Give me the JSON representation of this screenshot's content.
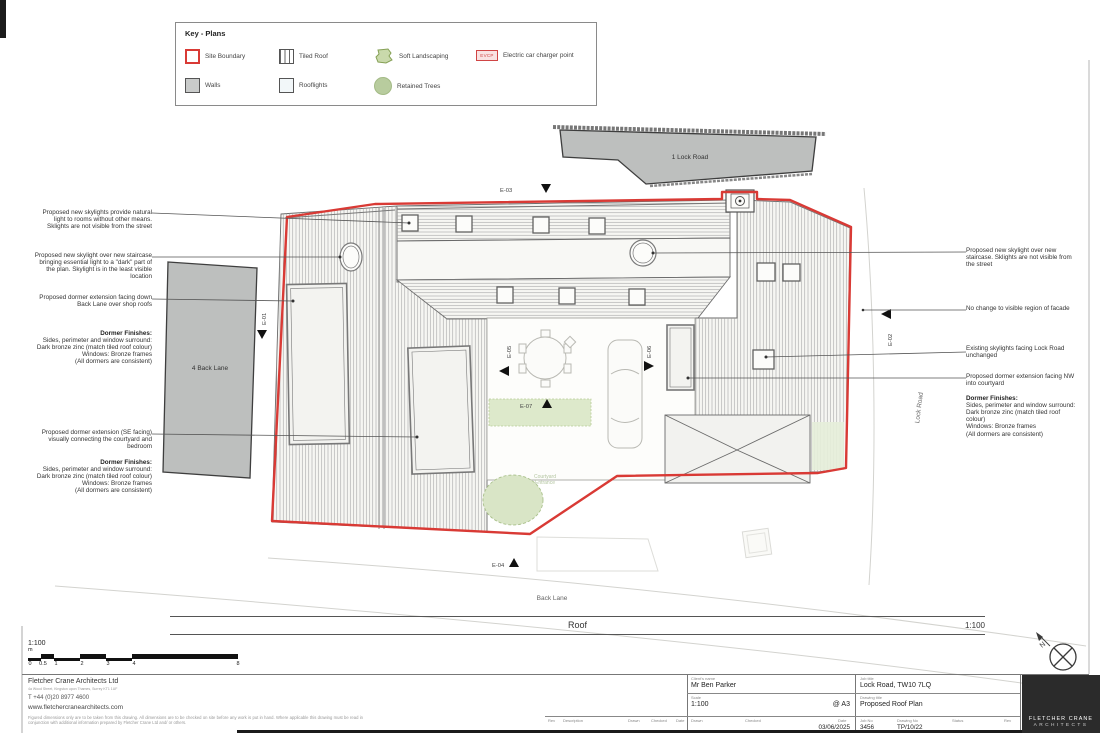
{
  "legend": {
    "title": "Key - Plans",
    "items": [
      {
        "label": "Site Boundary"
      },
      {
        "label": "Tiled Roof"
      },
      {
        "label": "Soft Landscaping"
      },
      {
        "label": "Electric car charger point",
        "badge": "EVCP"
      },
      {
        "label": "Walls"
      },
      {
        "label": "Rooflights"
      },
      {
        "label": "Retained Trees"
      }
    ]
  },
  "plan": {
    "buildings": {
      "lock_road": "1 Lock Road",
      "back_lane": "4 Back Lane"
    },
    "streets": {
      "back_lane": "Back Lane",
      "lock_road": "Lock Road"
    },
    "courtyard_line1": "Courtyard",
    "courtyard_line2": "Entrance",
    "markers": {
      "e01": "E-01",
      "e02": "E-02",
      "e03": "E-03",
      "e04": "E-04",
      "e05": "E-05",
      "e06": "E-06",
      "e07": "E-07"
    },
    "compass_label": "N"
  },
  "annotations": {
    "left": [
      {
        "text": "Proposed new skylights provide natural light to rooms without other means. Sklights are not visible from the street"
      },
      {
        "text": "Proposed new skylight over new staircase bringing essential light to a \"dark\" part of the plan. Skylight is in the least visible location"
      },
      {
        "text": "Proposed dormer extension facing down Back Lane over shop roofs"
      },
      {
        "title": "Dormer Finishes:",
        "text": "Sides, perimeter and window surround: Dark bronze zinc (match tiled roof colour)\nWindows: Bronze frames\n(All dormers are consistent)"
      },
      {
        "text": "Proposed dormer extension (SE facing) visually connecting the courtyard and bedroom"
      },
      {
        "title": "Dormer Finishes:",
        "text": "Sides, perimeter and window surround: Dark bronze zinc (match tiled roof colour)\nWindows: Bronze frames\n(All dormers are consistent)"
      }
    ],
    "right": [
      {
        "text": "Proposed new skylight over new staircase. Sklights are not visible from the street"
      },
      {
        "text": "No change to visible region of facade"
      },
      {
        "text": "Existing skylights facing Lock Road unchanged"
      },
      {
        "text": "Proposed dormer extension facing NW into courtyard"
      },
      {
        "title": "Dormer Finishes:",
        "text": "Sides, perimeter and window surround: Dark bronze zinc (match tiled roof colour)\nWindows: Bronze frames\n(All dormers are consistent)"
      }
    ]
  },
  "titlebar": {
    "name": "Roof",
    "scale": "1:100"
  },
  "scalebar": {
    "scale": "1:100",
    "unit": "m",
    "ticks": [
      "0",
      "0.5",
      "1",
      "2",
      "3",
      "4",
      "8"
    ]
  },
  "firm": {
    "name": "Fletcher Crane Architects Ltd",
    "address": "4a Wood Street, Kingston upon Thames, Surrey KT1 1UF",
    "phone": "T  +44 (0)20 8977 4600",
    "website": "www.fletchercranearchitects.com",
    "disclaimer": "Figured dimensions only are to be taken from this drawing. All dimensions are to be checked on site before any work is put in hand. Where applicable this drawing must be read in conjunction with additional information prepared by Fletcher Crane Ltd and/ or others."
  },
  "titleblock": {
    "rev_label": "Rev",
    "description_label": "Description",
    "drawn_label": "Drawn",
    "checked_label": "Checked",
    "date_label": "Date",
    "client_label": "Client's name",
    "client": "Mr Ben Parker",
    "scale_label": "Scale",
    "scale": "1:100",
    "paper": "@ A3",
    "date": "03/06/2025",
    "job_title_label": "Job title",
    "job_title": "Lock Road, TW10 7LQ",
    "drawing_title_label": "Drawing title",
    "drawing_title": "Proposed Roof Plan",
    "job_no_label": "Job No",
    "job_no": "3456",
    "drawing_no_label": "Drawing No",
    "drawing_no": "TP/10/22",
    "status_label": "Status",
    "rev2_label": "Rev"
  },
  "logo": {
    "line1": "FLETCHER CRANE",
    "line2": "ARCHITECTS"
  }
}
